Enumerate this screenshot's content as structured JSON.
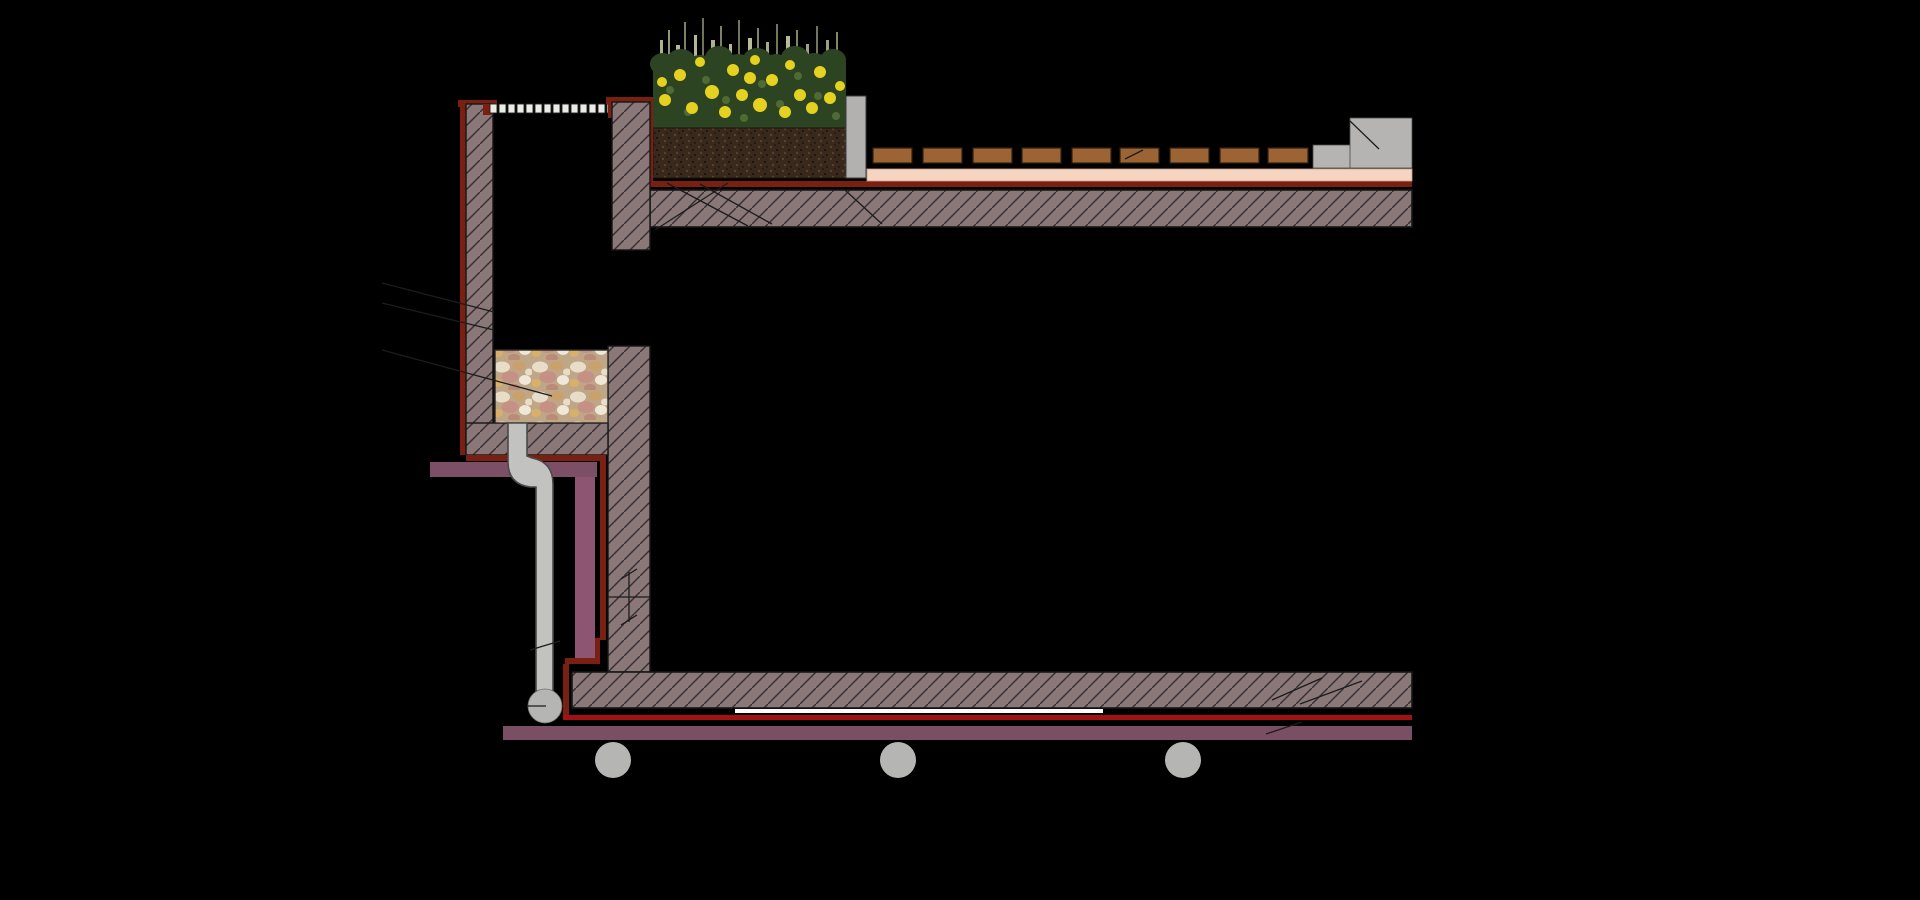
{
  "canvas": {
    "width": 1920,
    "height": 900,
    "background": "#000000"
  },
  "drawing": {
    "kind": "construction-section-detail",
    "subject": "roof planter and deck drainage detail"
  },
  "colors": {
    "background": "#000000",
    "hatch_fill": "#8a7878",
    "hatch_line": "#372e31",
    "outline": "#161616",
    "membrane_dark": "#7a2012",
    "membrane_bright": "#a31212",
    "purple_band": "#7d4f66",
    "purple_riser": "#8d5572",
    "purple_bottom": "#7b4f63",
    "salmon_layer": "#f6d4c2",
    "deck_board": "#9c6434",
    "deck_board_edge": "#30200f",
    "grate": "#ebebe7",
    "grate_edge": "#222222",
    "pipe": "#c2c2c0",
    "pipe_edge": "#4a4a4a",
    "ball": "#b5b5b3",
    "curb": "#b3b1af",
    "step": "#b5b4b2",
    "soil": "#38291c",
    "soil_dot_light": "#5a432d",
    "soil_dot_dark": "#170e08",
    "foliage": "#2d4423",
    "foliage_light": "#4f6b33",
    "flower": "#e5d120",
    "pebble_bg": "#bfa686",
    "pebble_cream": "#e8ddc9",
    "pebble_tan": "#caa06b",
    "pebble_pink": "#c59186",
    "pebble_white": "#efe8d8",
    "pebble_gold": "#d8b06a",
    "pebble_rose": "#b98b78",
    "leader_line": "#1c1c1c",
    "underlay_white": "#ffffff",
    "blackout_box": "#000000"
  },
  "parts": {
    "grate": "drain-channel-grate",
    "left_wall": "channel-wall-left",
    "right_wall": "channel-wall-right",
    "membrane": "waterproofing-membrane",
    "planter": "planter-with-flowers",
    "soil": "planting-soil",
    "curb": "concrete-curb",
    "deck": "deck-boards",
    "step": "pedestal-step",
    "top_slab": "upper-structural-slab",
    "gravel": "drainage-gravel-box",
    "pipe": "rainwater-drain-pipe",
    "insulation_mid": "soffit-insulation-band",
    "insulation_riser": "wall-insulation-riser",
    "bottom_slab": "lower-structural-slab",
    "bottom_insulation": "ceiling-insulation-band",
    "conduits": "service-conduits",
    "screed": "bedding-screed-layer",
    "break_mark": "section-break-symbol",
    "leaders": "annotation-leader-lines"
  }
}
